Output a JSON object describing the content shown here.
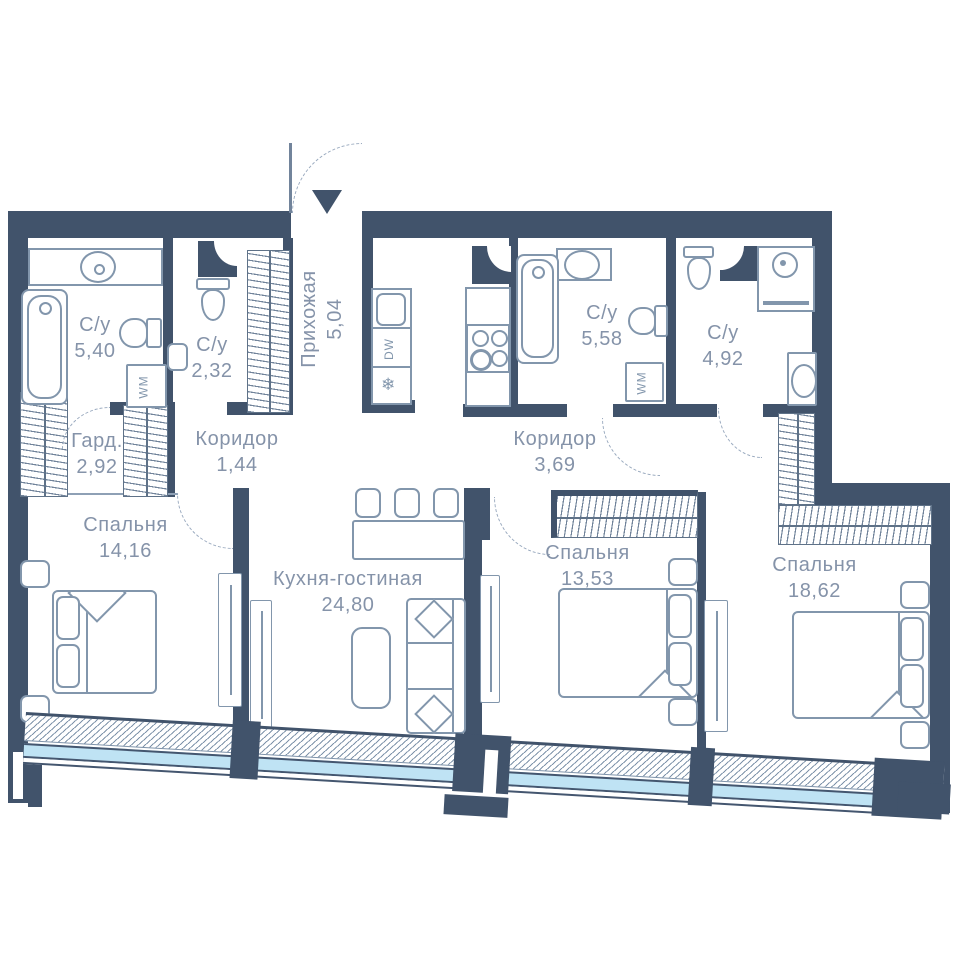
{
  "plan": {
    "type": "apartment-floor-plan",
    "language": "ru",
    "rooms": [
      {
        "name": "С/у",
        "area": "5,40"
      },
      {
        "name": "С/у",
        "area": "2,32"
      },
      {
        "name": "Прихожая",
        "area": "5,04"
      },
      {
        "name": "Гард.",
        "area": "2,92"
      },
      {
        "name": "Коридор",
        "area": "1,44"
      },
      {
        "name": "Спальня",
        "area": "14,16"
      },
      {
        "name": "Кухня-гостиная",
        "area": "24,80"
      },
      {
        "name": "С/у",
        "area": "5,58"
      },
      {
        "name": "Коридор",
        "area": "3,69"
      },
      {
        "name": "С/у",
        "area": "4,92"
      },
      {
        "name": "Спальня",
        "area": "13,53"
      },
      {
        "name": "Спальня",
        "area": "18,62"
      }
    ],
    "appliances": {
      "dishwasher": "DW",
      "washer": "WM"
    },
    "icons": {
      "fridge_glyph": "❄"
    },
    "colors": {
      "wall": "#41536b",
      "glass": "#bfe3f4",
      "label": "#8593a9",
      "fixture_outline": "#8296ac"
    }
  }
}
